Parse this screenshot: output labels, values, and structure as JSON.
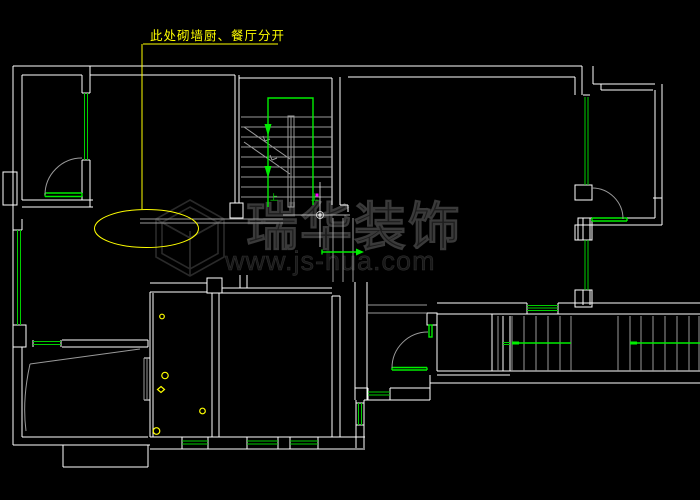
{
  "canvas": {
    "width": 700,
    "height": 500,
    "background": "#000000"
  },
  "annotation": {
    "label": "此处砌墙厨、餐厅分开",
    "color": "#FFFF00",
    "shape": "leader-line-with-ellipse"
  },
  "watermark": {
    "brand": "瑞华装饰",
    "url": "www.js-hua.com",
    "logo": "isometric-cube-logo",
    "color": "#2A2A2A"
  },
  "stair_main": {
    "up_label": "上",
    "route_color": "#00EE00"
  },
  "stair_corridor": {
    "direction_color": "#00EE00"
  },
  "palette": {
    "wall_white": "#FFFFFF",
    "detail_gray": "#9A9A9A",
    "window_green": "#00CF00",
    "annotation_yellow": "#FFFF00",
    "marker_magenta": "#FF00FF",
    "background_black": "#000000"
  }
}
